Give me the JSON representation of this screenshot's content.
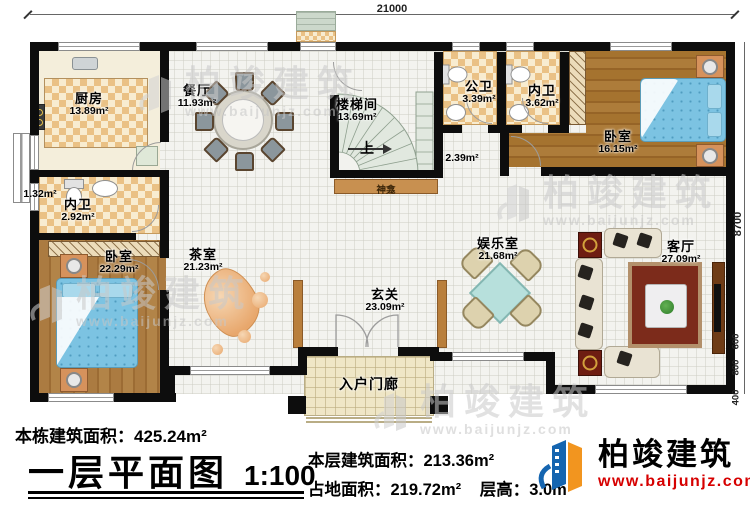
{
  "dim": {
    "top": "21000",
    "right": "8700",
    "seg600": "600",
    "seg800": "800",
    "seg400": "400"
  },
  "rooms": {
    "kitchen": {
      "name": "厨房",
      "area": "13.89m²"
    },
    "dining": {
      "name": "餐厅",
      "area": "11.93m²"
    },
    "stairwell": {
      "name": "楼梯间",
      "area": "13.69m²"
    },
    "public_bath": {
      "name": "公卫",
      "area": "3.39m²"
    },
    "ensuite_top": {
      "name": "内卫",
      "area": "3.62m²"
    },
    "bedroom_r": {
      "name": "卧室",
      "area": "16.15m²"
    },
    "ensuite_l": {
      "name": "内卫",
      "area": "2.92m²"
    },
    "bedroom_l": {
      "name": "卧室",
      "area": "22.29m²"
    },
    "tea": {
      "name": "茶室",
      "area": "21.23m²"
    },
    "foyer": {
      "name": "玄关",
      "area": "23.09m²"
    },
    "game": {
      "name": "娱乐室",
      "area": "21.68m²"
    },
    "living": {
      "name": "客厅",
      "area": "27.09m²"
    },
    "porch": {
      "name": "入户门廊"
    },
    "shrine": {
      "name": "神龛"
    },
    "closet": {
      "area": "1.32m²"
    },
    "hall": {
      "area": "2.39m²"
    },
    "stair_up": "上"
  },
  "footer": {
    "total_label": "本栋建筑面积：",
    "total_value": "425.24m²",
    "title": "一层平面图",
    "scale": "1:100",
    "floor_label": "本层建筑面积：",
    "floor_value": "213.36m²",
    "footprint_label": "占地面积：",
    "footprint_value": "219.72m²",
    "height_label": "层高：",
    "height_value": "3.0m"
  },
  "brand": {
    "name": "柏竣建筑",
    "url": "www.baijunjz.com",
    "colors": {
      "blue": "#1565b0",
      "orange": "#f2951f",
      "red": "#d60000"
    }
  },
  "watermark": {
    "cn": "柏竣建筑",
    "url": "www.baijunjz.com"
  }
}
